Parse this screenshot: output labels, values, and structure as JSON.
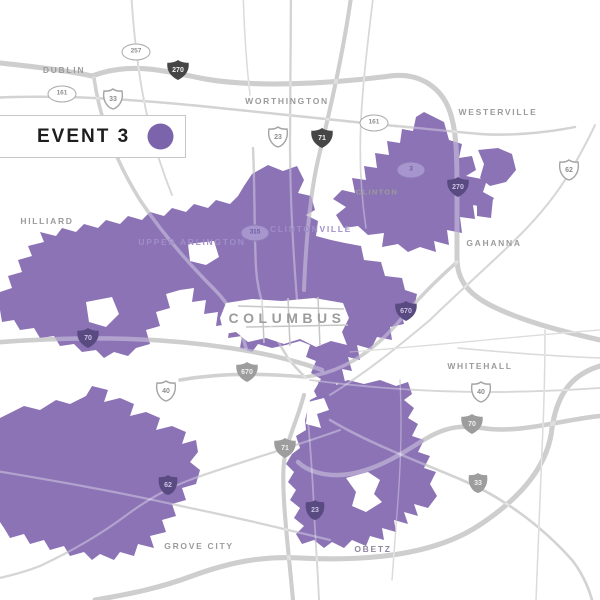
{
  "colors": {
    "event_region": "#8b73b5",
    "legend_swatch": "#7c64ac",
    "road": "#b5b5b5",
    "label_gray": "#9b9b9b",
    "label_on_region": "#a08ec7"
  },
  "legend": {
    "title": "EVENT 3"
  },
  "map": {
    "labels": {
      "dublin": "DUBLIN",
      "worthington": "WORTHINGTON",
      "westerville": "WESTERVILLE",
      "hilliard": "HILLIARD",
      "upper_arlington": "UPPER ARLINGTON",
      "clintonville": "CLINTONVILLE",
      "clinton": "CLINTON",
      "gahanna": "GAHANNA",
      "columbus": "COLUMBUS",
      "whitehall": "WHITEHALL",
      "grove_city": "GROVE CITY",
      "obetz": "OBETZ"
    },
    "shields": {
      "sr257": "257",
      "i270_nw": "270",
      "sr161_w": "161",
      "us33_nw": "33",
      "us23_n": "23",
      "i71_n": "71",
      "sr161_e": "161",
      "sr3": "3",
      "i270_e": "270",
      "us62_ne": "62",
      "sr315": "315",
      "i70_w": "70",
      "i670_w": "670",
      "i670_e": "670",
      "us40_w": "40",
      "us40_e": "40",
      "i71_s": "71",
      "i70_e": "70",
      "us33_se": "33",
      "us23_s": "23",
      "us62_sw": "62"
    }
  }
}
